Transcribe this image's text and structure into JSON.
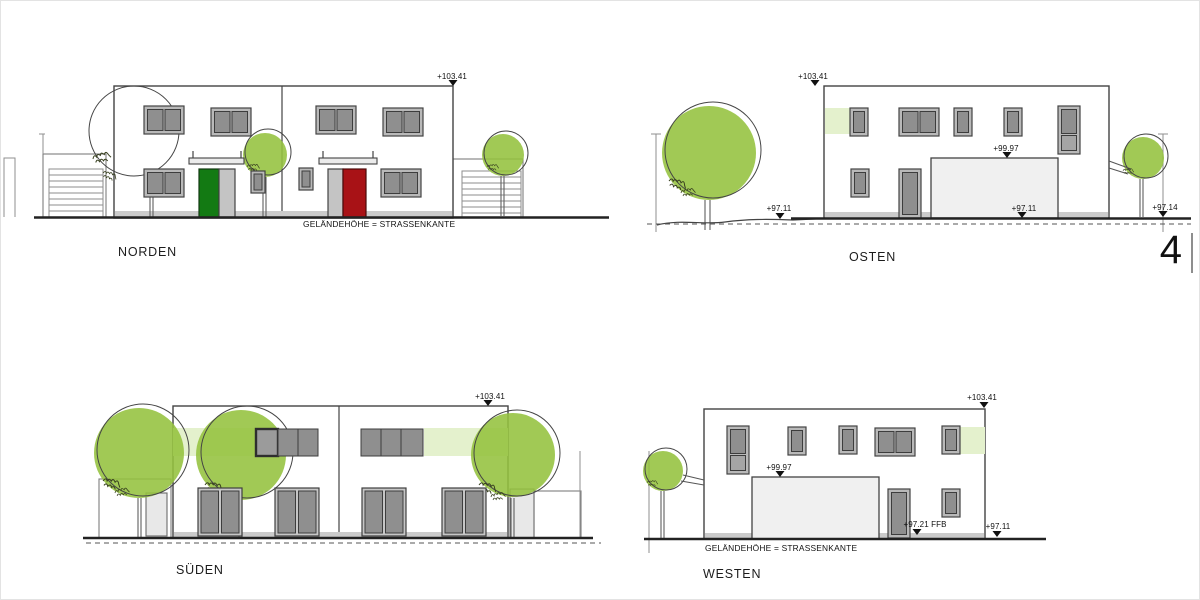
{
  "sheet": {
    "number": "4"
  },
  "views": {
    "norden": {
      "label": "NORDEN",
      "markers": {
        "top": "+103.41"
      },
      "ground_note": "GELÄNDEHÖHE = STRASSENKANTE"
    },
    "osten": {
      "label": "OSTEN",
      "markers": {
        "top": "+103.41",
        "garage_top": "+99.97",
        "ground_left": "+97.11",
        "ground_right": "+97.11",
        "ground_far_right": "+97.14"
      }
    },
    "sueden": {
      "label": "SÜDEN",
      "markers": {
        "top": "+103.41"
      }
    },
    "westen": {
      "label": "WESTEN",
      "markers": {
        "top": "+103.41",
        "garage_top": "+99.97",
        "finished_floor": "+97.21  FFB",
        "ground_right": "+97.11"
      },
      "ground_note": "GELÄNDEHÖHE = STRASSENKANTE"
    }
  },
  "colors": {
    "tree_green": "#94c13d",
    "tint_green": "#e4f1cd",
    "pane_gray": "#8f8f8f",
    "frame_gray": "#b9b9b9",
    "stroke_dark": "#434343",
    "door_green": "#137a13",
    "door_red": "#a81216",
    "garage_fill": "#f0f0f0",
    "base_strip": "#cbcbcb",
    "ground_line": "#222222"
  }
}
